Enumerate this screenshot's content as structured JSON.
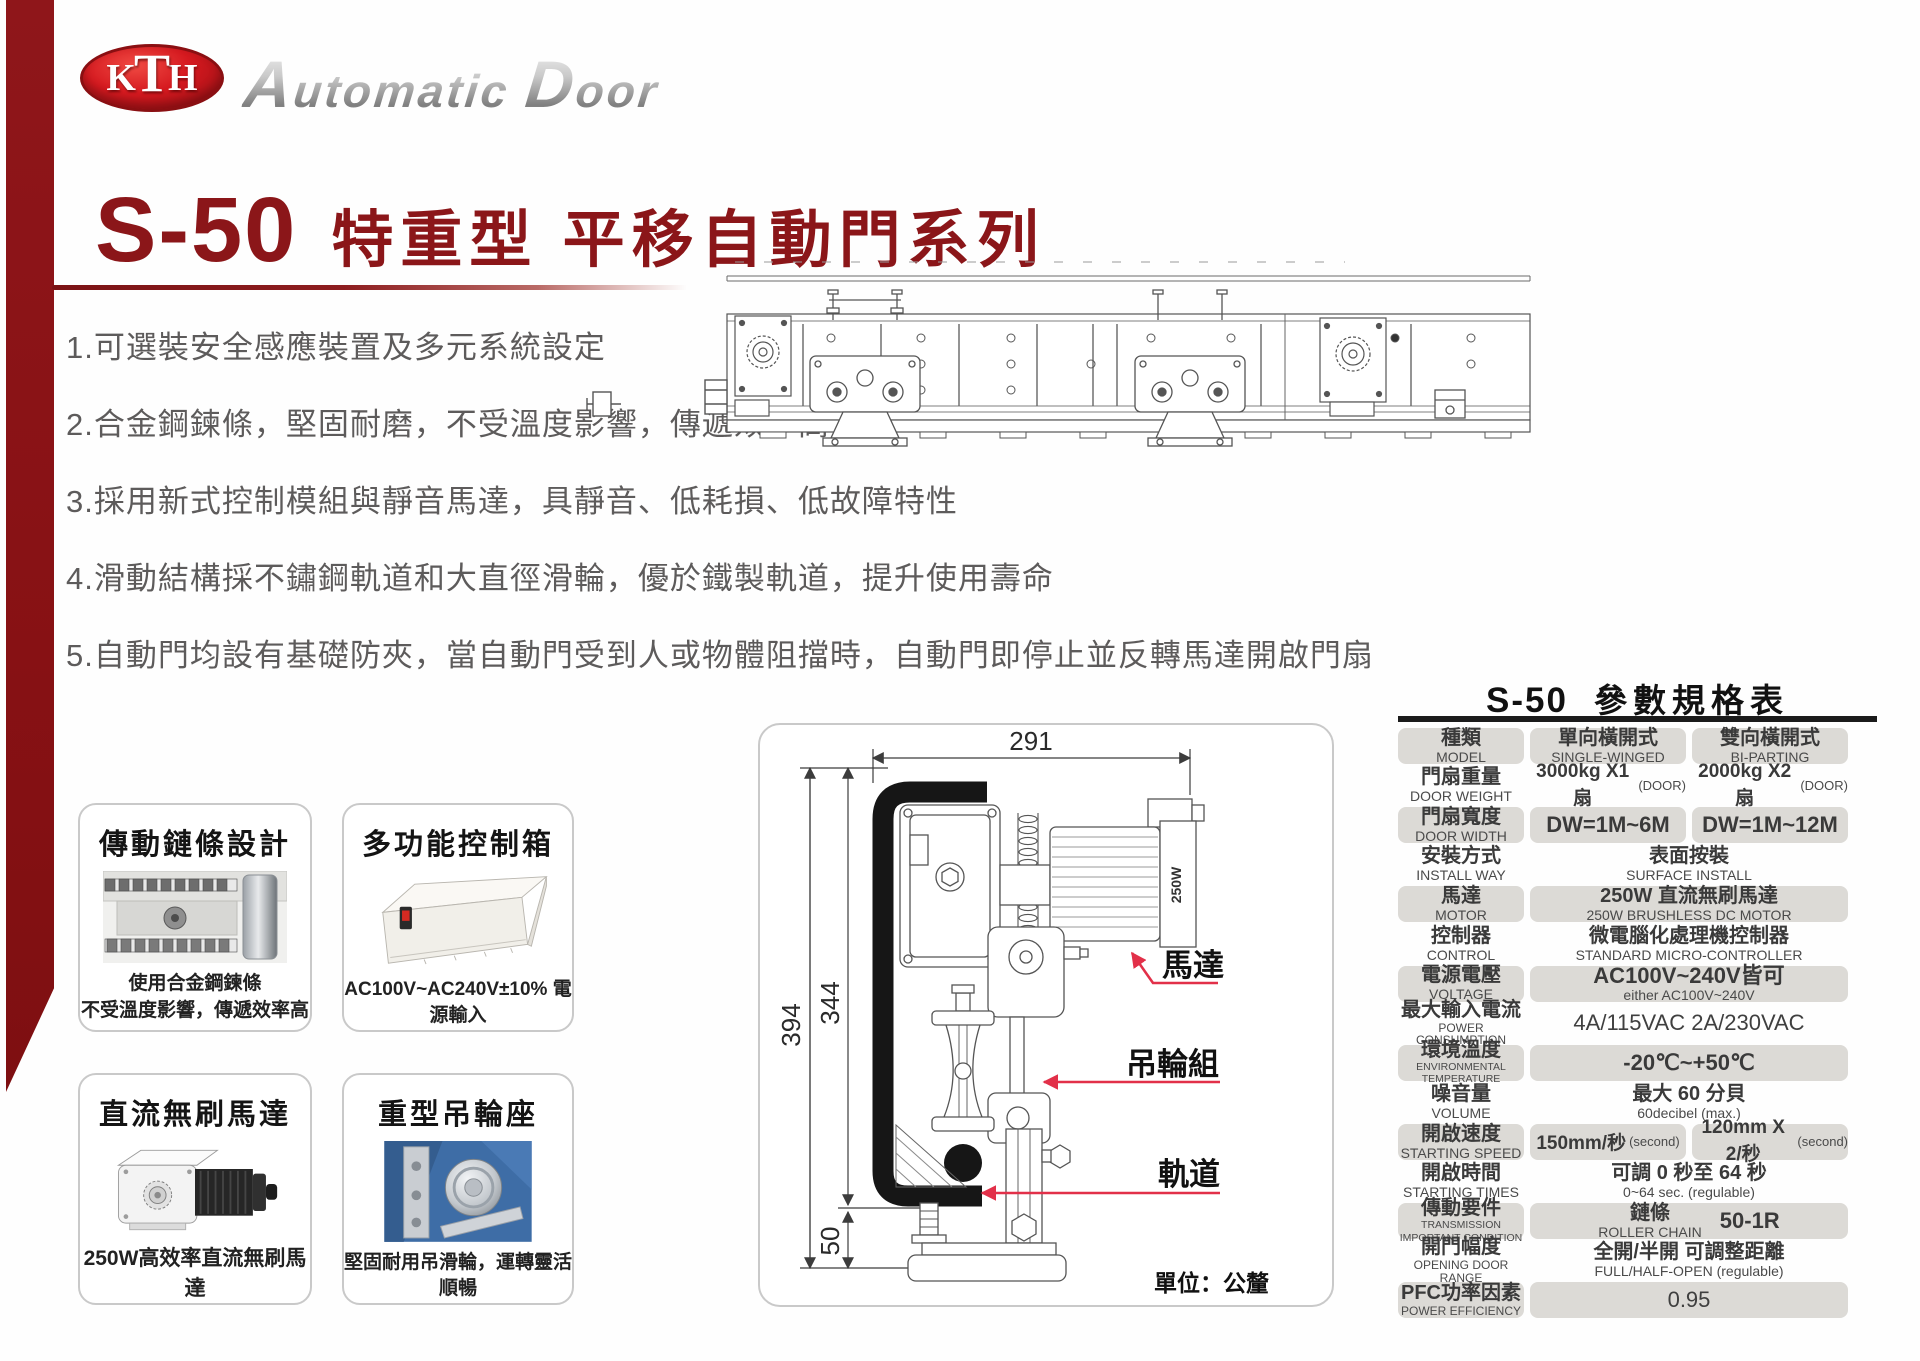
{
  "brand": {
    "mark_k": "K",
    "mark_t": "T",
    "mark_h": "H",
    "name_a": "A",
    "name_b": "utomatic",
    "name_c": "D",
    "name_d": "oor"
  },
  "header": {
    "model": "S-50",
    "series": "特重型 平移自動門系列"
  },
  "features": [
    "1.可選裝安全感應裝置及多元系統設定",
    "2.合金鋼鍊條，堅固耐磨，不受溫度影響，傳遞效率高",
    "3.採用新式控制模組與靜音馬達，具靜音、低耗損、低故障特性",
    "4.滑動結構採不鏽鋼軌道和大直徑滑輪，優於鐵製軌道，提升使用壽命",
    "5.自動門均設有基礎防夾，當自動門受到人或物體阻擋時，自動門即停止並反轉馬達開啟門扇"
  ],
  "cards": [
    {
      "title": "傳動鏈條設計",
      "caption1": "使用合金鋼鍊條",
      "caption2": "不受溫度影響，傳遞效率高"
    },
    {
      "title": "多功能控制箱",
      "caption1": "AC100V~AC240V±10% 電源輸入",
      "caption2": ""
    },
    {
      "title": "直流無刷馬達",
      "caption1": "250W高效率直流無刷馬達",
      "caption2": ""
    },
    {
      "title": "重型吊輪座",
      "caption1": "堅固耐用吊滑輪，運轉靈活順暢",
      "caption2": ""
    }
  ],
  "diagram": {
    "dims": {
      "top": "291",
      "left_outer": "394",
      "left_inner": "344",
      "bottom": "50"
    },
    "motor_tag": "250W",
    "labels": {
      "motor": "馬達",
      "roller": "吊輪組",
      "rail": "軌道"
    },
    "unit": "單位：公釐"
  },
  "accent_colors": {
    "brand_red": "#8b1619",
    "callout_red": "#e23049",
    "cell_gray": "#dcdad6"
  },
  "spec_table": {
    "title_model": "S-50",
    "title_text": "參數規格表",
    "rows": [
      {
        "zh": "種類",
        "en": "MODEL",
        "c1zh": "單向橫開式",
        "c1en": "SINGLE-WINGED",
        "c2zh": "雙向橫開式",
        "c2en": "BI-PARTING"
      },
      {
        "zh": "門扇重量",
        "en": "DOOR WEIGHT",
        "c1": "3000kg X1 扇",
        "c1p": "(DOOR)",
        "c2": "2000kg X2 扇",
        "c2p": "(DOOR)"
      },
      {
        "zh": "門扇寬度",
        "en": "DOOR WIDTH",
        "c1": "DW=1M~6M",
        "c2": "DW=1M~12M"
      },
      {
        "zh": "安裝方式",
        "en": "INSTALL WAY",
        "vzh": "表面按裝",
        "ven": "SURFACE INSTALL"
      },
      {
        "zh": "馬達",
        "en": "MOTOR",
        "vzh": "250W  直流無刷馬達",
        "ven": "250W BRUSHLESS DC MOTOR"
      },
      {
        "zh": "控制器",
        "en": "CONTROL",
        "vzh": "微電腦化處理機控制器",
        "ven": "STANDARD  MICRO-CONTROLLER"
      },
      {
        "zh": "電源電壓",
        "en": "VOLTAGE",
        "vzh": "AC100V~240V皆可",
        "ven": "either AC100V~240V"
      },
      {
        "zh": "最大輸入電流",
        "en": "POWER CONSUMPTION",
        "v": "4A/115VAC 2A/230VAC"
      },
      {
        "zh": "環境溫度",
        "en": "ENVIRONMENTAL",
        "en2": "TEMPERATURE",
        "v": "-20℃~+50℃"
      },
      {
        "zh": "噪音量",
        "en": "VOLUME",
        "vzh": "最大 60 分貝",
        "ven": "60decibel (max.)"
      },
      {
        "zh": "開啟速度",
        "en": "STARTING SPEED",
        "c1": "150mm/秒",
        "c1p": "(second)",
        "c2": "120mm X 2/秒",
        "c2p": "(second)"
      },
      {
        "zh": "開啟時間",
        "en": "STARTING TIMES",
        "vzh": "可調 0 秒至 64 秒",
        "ven": "0~64 sec. (regulable)"
      },
      {
        "zh": "傳動要件",
        "en": "TRANSMISSION",
        "en2": "IMPORTANT CONDITION",
        "vzh": "鏈條",
        "ven": "ROLLER CHAIN",
        "side": "50-1R"
      },
      {
        "zh": "開門幅度",
        "en": "OPENING DOOR RANGE",
        "vzh": "全開/半開 可調整距離",
        "ven": "FULL/HALF-OPEN  (regulable)"
      },
      {
        "zh": "PFC功率因素",
        "en": "POWER EFFICIENCY",
        "v": "0.95"
      }
    ]
  }
}
